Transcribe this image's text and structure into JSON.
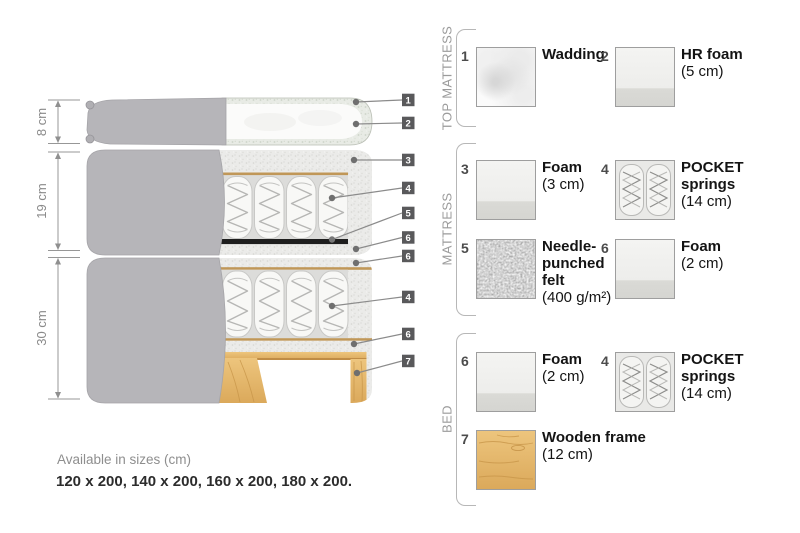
{
  "diagram": {
    "dimensions": [
      {
        "label": "8 cm"
      },
      {
        "label": "19 cm"
      },
      {
        "label": "30 cm"
      }
    ],
    "callouts": [
      {
        "n": "1"
      },
      {
        "n": "2"
      },
      {
        "n": "3"
      },
      {
        "n": "4"
      },
      {
        "n": "5"
      },
      {
        "n": "6"
      },
      {
        "n": "6"
      },
      {
        "n": "4"
      },
      {
        "n": "6"
      },
      {
        "n": "7"
      }
    ]
  },
  "legend": {
    "sections": [
      {
        "label": "TOP MATTRESS",
        "items": [
          {
            "num": "1",
            "title": "Wadding",
            "sub": "",
            "texture": "wadding"
          },
          {
            "num": "2",
            "title": "HR foam",
            "sub": "(5 cm)",
            "texture": "foam"
          }
        ]
      },
      {
        "label": "MATTRESS",
        "items": [
          {
            "num": "3",
            "title": "Foam",
            "sub": "(3 cm)",
            "texture": "foam"
          },
          {
            "num": "4",
            "title": "POCKET springs",
            "sub": "(14 cm)",
            "texture": "pocket-springs"
          },
          {
            "num": "5",
            "title": "Needle-punched felt",
            "sub": "(400 g/m²)",
            "texture": "felt"
          },
          {
            "num": "6",
            "title": "Foam",
            "sub": "(2 cm)",
            "texture": "foam"
          }
        ]
      },
      {
        "label": "BED",
        "items": [
          {
            "num": "6",
            "title": "Foam",
            "sub": "(2 cm)",
            "texture": "foam"
          },
          {
            "num": "4",
            "title": "POCKET springs",
            "sub": "(14 cm)",
            "texture": "pocket-springs"
          },
          {
            "num": "7",
            "title": "Wooden frame",
            "sub": "(12 cm)",
            "texture": "wood"
          }
        ]
      }
    ]
  },
  "sizes": {
    "title": "Available in sizes (cm)",
    "values": "120 x 200, 140 x 200, 160 x 200, 180 x 200."
  },
  "colors": {
    "cover_gray": "#b6b5b9",
    "felt_black": "#1e1e1e",
    "wood_tan": "#e3b66c",
    "callout_badge": "#59595b",
    "accent_tan_line": "#c09758"
  }
}
